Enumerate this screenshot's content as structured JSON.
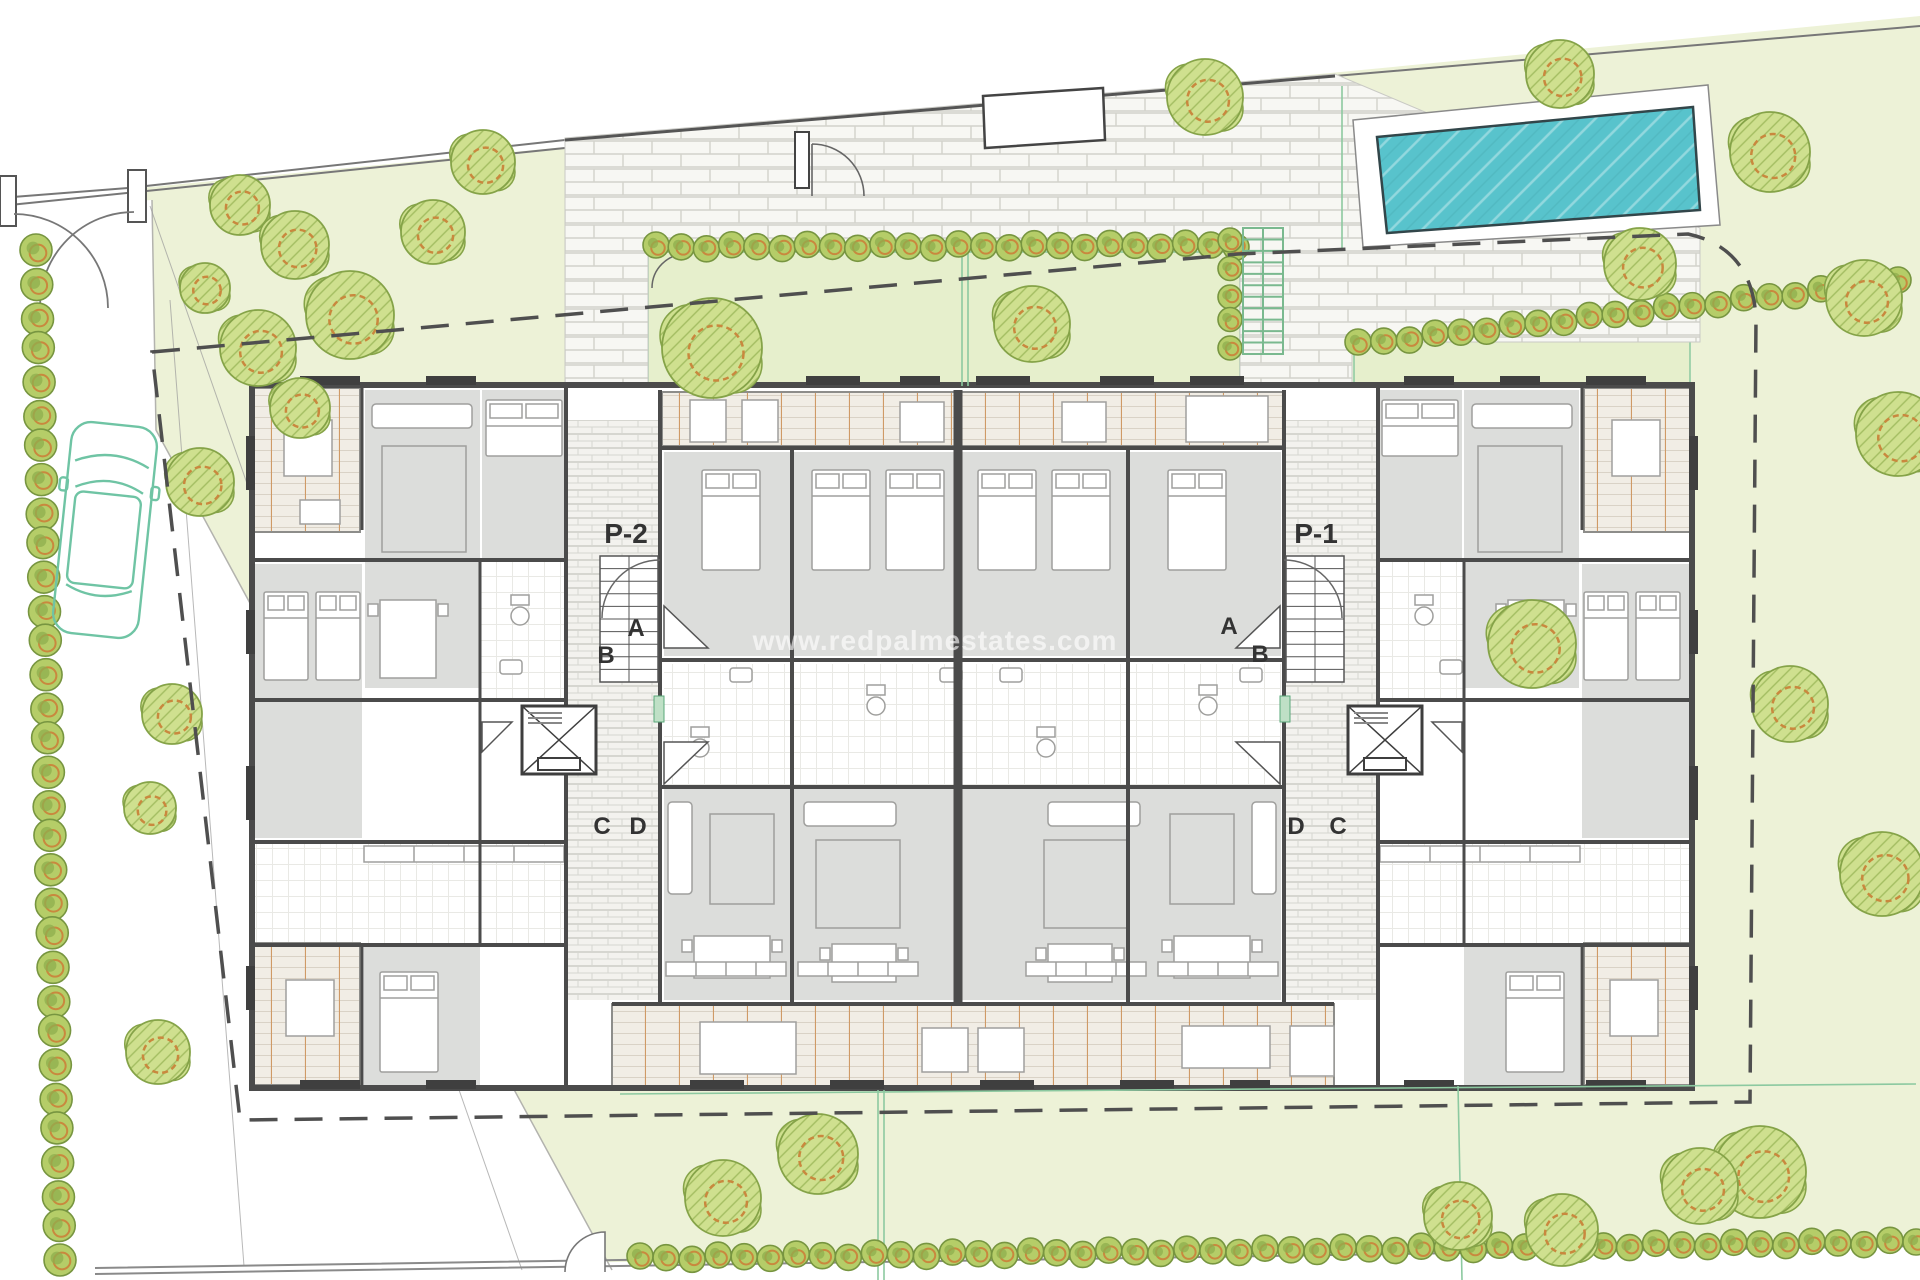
{
  "document": {
    "type": "residential-site-plan-ground-floor",
    "watermark": "www.redpalmestates.com"
  },
  "labels": {
    "core_left": "P-2",
    "core_right": "P-1",
    "unit_doors": [
      "A",
      "B",
      "C",
      "D"
    ]
  },
  "plan_labels": [
    {
      "id": "core-left-label",
      "text": "P-2",
      "x": 626,
      "y": 543,
      "size": 28,
      "weight": "bold"
    },
    {
      "id": "core-right-label",
      "text": "P-1",
      "x": 1316,
      "y": 543,
      "size": 28,
      "weight": "bold"
    },
    {
      "id": "door-a-left",
      "text": "A",
      "x": 636,
      "y": 636,
      "size": 24,
      "weight": "bold"
    },
    {
      "id": "door-b-left",
      "text": "B",
      "x": 606,
      "y": 663,
      "size": 24,
      "weight": "bold"
    },
    {
      "id": "door-c-left",
      "text": "C",
      "x": 602,
      "y": 834,
      "size": 24,
      "weight": "bold"
    },
    {
      "id": "door-d-left",
      "text": "D",
      "x": 638,
      "y": 834,
      "size": 24,
      "weight": "bold"
    },
    {
      "id": "door-a-right",
      "text": "A",
      "x": 1229,
      "y": 634,
      "size": 24,
      "weight": "bold"
    },
    {
      "id": "door-b-right",
      "text": "B",
      "x": 1260,
      "y": 662,
      "size": 24,
      "weight": "bold"
    },
    {
      "id": "door-d-right",
      "text": "D",
      "x": 1296,
      "y": 834,
      "size": 24,
      "weight": "bold"
    },
    {
      "id": "door-c-right",
      "text": "C",
      "x": 1338,
      "y": 834,
      "size": 24,
      "weight": "bold"
    }
  ],
  "site": {
    "pool": {
      "deck": [
        [
          1353,
          120
        ],
        [
          1708,
          85
        ],
        [
          1720,
          225
        ],
        [
          1363,
          247
        ]
      ],
      "water": [
        [
          1377,
          137
        ],
        [
          1693,
          107
        ],
        [
          1700,
          210
        ],
        [
          1387,
          233
        ]
      ]
    },
    "car": {
      "x": 62,
      "y": 424,
      "width": 86,
      "height": 212,
      "angle": 6
    },
    "stairs": {
      "x": 1243,
      "y": 228,
      "width": 40,
      "height": 126,
      "steps": 10
    },
    "trees": [
      [
        240,
        205,
        30
      ],
      [
        295,
        245,
        34
      ],
      [
        350,
        315,
        44
      ],
      [
        258,
        348,
        38
      ],
      [
        205,
        288,
        25
      ],
      [
        300,
        408,
        30
      ],
      [
        433,
        232,
        32
      ],
      [
        483,
        162,
        32
      ],
      [
        200,
        482,
        34
      ],
      [
        172,
        714,
        30
      ],
      [
        150,
        808,
        26
      ],
      [
        158,
        1052,
        32
      ],
      [
        712,
        348,
        50
      ],
      [
        1032,
        324,
        38
      ],
      [
        1205,
        97,
        38
      ],
      [
        1560,
        74,
        34
      ],
      [
        1770,
        152,
        40
      ],
      [
        1640,
        264,
        36
      ],
      [
        1864,
        298,
        38
      ],
      [
        1898,
        434,
        42
      ],
      [
        1532,
        644,
        44
      ],
      [
        1790,
        704,
        38
      ],
      [
        1882,
        874,
        42
      ],
      [
        1760,
        1172,
        46
      ],
      [
        1562,
        1230,
        36
      ],
      [
        1700,
        1186,
        38
      ],
      [
        1458,
        1216,
        34
      ],
      [
        723,
        1198,
        38
      ],
      [
        818,
        1154,
        40
      ]
    ],
    "hedges": [
      {
        "x1": 36,
        "y1": 252,
        "x2": 60,
        "y2": 1260,
        "r": 16,
        "count": 32
      },
      {
        "x1": 656,
        "y1": 247,
        "x2": 1236,
        "y2": 245,
        "r": 13,
        "count": 24
      },
      {
        "x1": 1358,
        "y1": 344,
        "x2": 1898,
        "y2": 282,
        "r": 13,
        "count": 22
      },
      {
        "x1": 640,
        "y1": 1258,
        "x2": 1916,
        "y2": 1242,
        "r": 13,
        "count": 50
      },
      {
        "x1": 1230,
        "y1": 242,
        "x2": 1230,
        "y2": 348,
        "r": 12,
        "count": 5
      }
    ]
  },
  "colors": {
    "site_green": "#edf2d7",
    "courtyard_green": "#e6efcc",
    "paving": "#f7f7f3",
    "paving_line": "#d2d2cb",
    "wall": "#4b4b4b",
    "window_dark": "#3f3f3f",
    "room_gray": "#dcdddb",
    "furniture_line": "#9f9f9d",
    "tile_line": "#e3e3df",
    "deck_base": "#f1ede5",
    "deck_line": "#d9d2c6",
    "deck_accent": "#cf9a66",
    "pool_water": "#58c3cc",
    "pool_edge": "#32464a",
    "tree_fill": "#cfe08f",
    "tree_line": "#85a348",
    "tree_hatch": "#a3bd61",
    "tree_ring": "#c9883e",
    "bush_fill": "#b5cd68",
    "bush_line": "#779540",
    "bush_ring": "#c9883e",
    "bush_core": "#8fae4e",
    "car_outline": "#6fc4a4",
    "stairs_green": "#7ab98f",
    "accent_green_line": "#8cc9a0",
    "boundary_dash": "#4f4f4f",
    "fence": "#8a8a8a",
    "label": "#333333",
    "watermark": "rgba(255,255,255,0.62)"
  }
}
